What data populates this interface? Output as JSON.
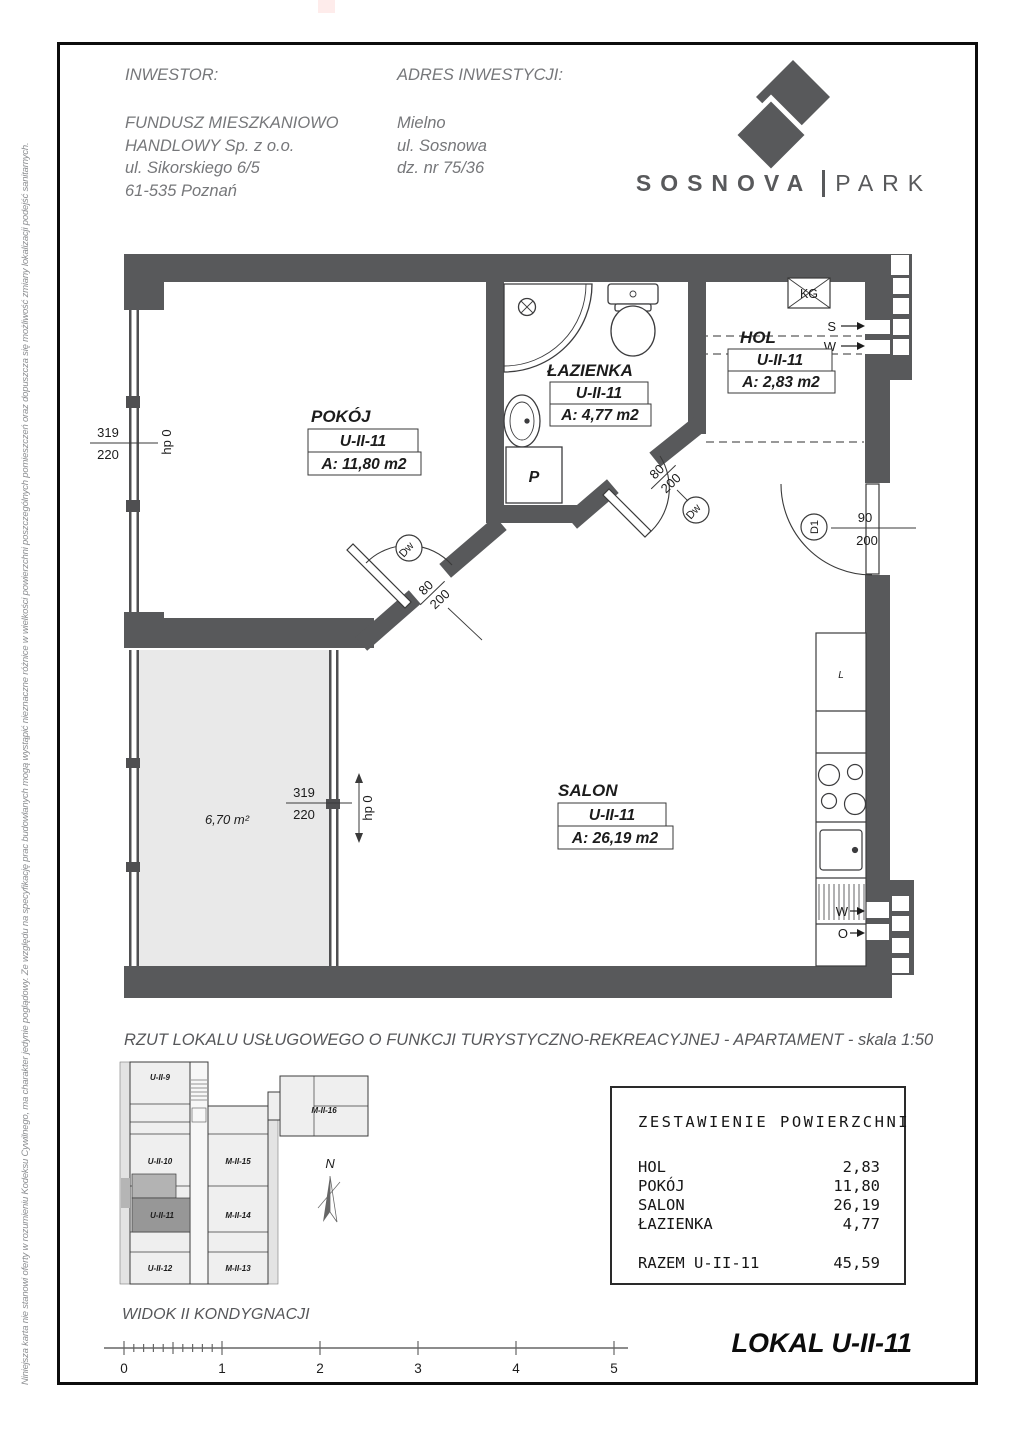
{
  "header": {
    "investor_label": "INWESTOR:",
    "investor_lines": [
      "FUNDUSZ MIESZKANIOWO",
      "HANDLOWY Sp. z o.o.",
      "ul. Sikorskiego 6/5",
      "61-535 Poznań"
    ],
    "address_label": "ADRES INWESTYCJI:",
    "address_lines": [
      "Mielno",
      "ul. Sosnowa",
      "dz. nr 75/36"
    ],
    "logo": {
      "brand_left": "SOSNOVA",
      "brand_right": "PARK"
    }
  },
  "side_note": "Niniejsza karta nie stanowi oferty w rozumieniu Kodeksu Cywilnego, ma charakter jedynie poglądowy. Ze względu na specyfikację prac budowlanych mogą wystąpić nieznaczne różnice w wielkości powierzchni poszczególnych pomieszczeń oraz dopuszcza się możliwość zmiany lokalizacji podejść sanitarnych.",
  "plan": {
    "rooms": [
      {
        "name": "POKÓJ",
        "unit": "U-II-11",
        "area": "A: 11,80 m2"
      },
      {
        "name": "ŁAZIENKA",
        "unit": "U-II-11",
        "area": "A: 4,77 m2"
      },
      {
        "name": "HOL",
        "unit": "U-II-11",
        "area": "A: 2,83 m2"
      },
      {
        "name": "SALON",
        "unit": "U-II-11",
        "area": "A: 26,19 m2"
      }
    ],
    "balcony_area": "6,70 m²",
    "windows": {
      "pokoj": {
        "w": "319",
        "h": "220",
        "sill": "hp 0"
      },
      "salon": {
        "w": "319",
        "h": "220",
        "sill": "hp 0"
      }
    },
    "doors": {
      "pokoj": {
        "code": "Dw",
        "width": "80",
        "height": "200"
      },
      "bath": {
        "code": "Dw",
        "width": "80",
        "height": "200"
      },
      "entry": {
        "code": "D1",
        "width": "90",
        "height": "200"
      }
    },
    "symbols": {
      "kg": "KG",
      "vent_s": "S",
      "vent_w": "W",
      "kitchen_w": "W",
      "kitchen_o": "O",
      "fridge": "L",
      "washer": "P"
    }
  },
  "caption": "RZUT LOKALU USŁUGOWEGO O FUNKCJI TURYSTYCZNO-REKREACYJNEJ - APARTAMENT - skala 1:50",
  "overview": {
    "title": "WIDOK II KONDYGNACJI",
    "units": [
      "U-II-9",
      "U-II-10",
      "U-II-11",
      "U-II-12",
      "M-II-15",
      "M-II-14",
      "M-II-13",
      "M-II-16"
    ],
    "north": "N",
    "scale_ticks": [
      "0",
      "1",
      "2",
      "3",
      "4",
      "5"
    ]
  },
  "area_table": {
    "title": "ZESTAWIENIE POWIERZCHNI",
    "rows": [
      [
        "HOL",
        "2,83"
      ],
      [
        "POKÓJ",
        "11,80"
      ],
      [
        "SALON",
        "26,19"
      ],
      [
        "ŁAZIENKA",
        "4,77"
      ]
    ],
    "total_label": "RAZEM U-II-11",
    "total_value": "45,59"
  },
  "footer": {
    "lokal_title": "LOKAL U-II-11"
  },
  "colors": {
    "wall": "#58595b",
    "balcony_fill": "#e9e9e9",
    "accent_text": "#76777a",
    "frame": "#0d0d0d"
  }
}
